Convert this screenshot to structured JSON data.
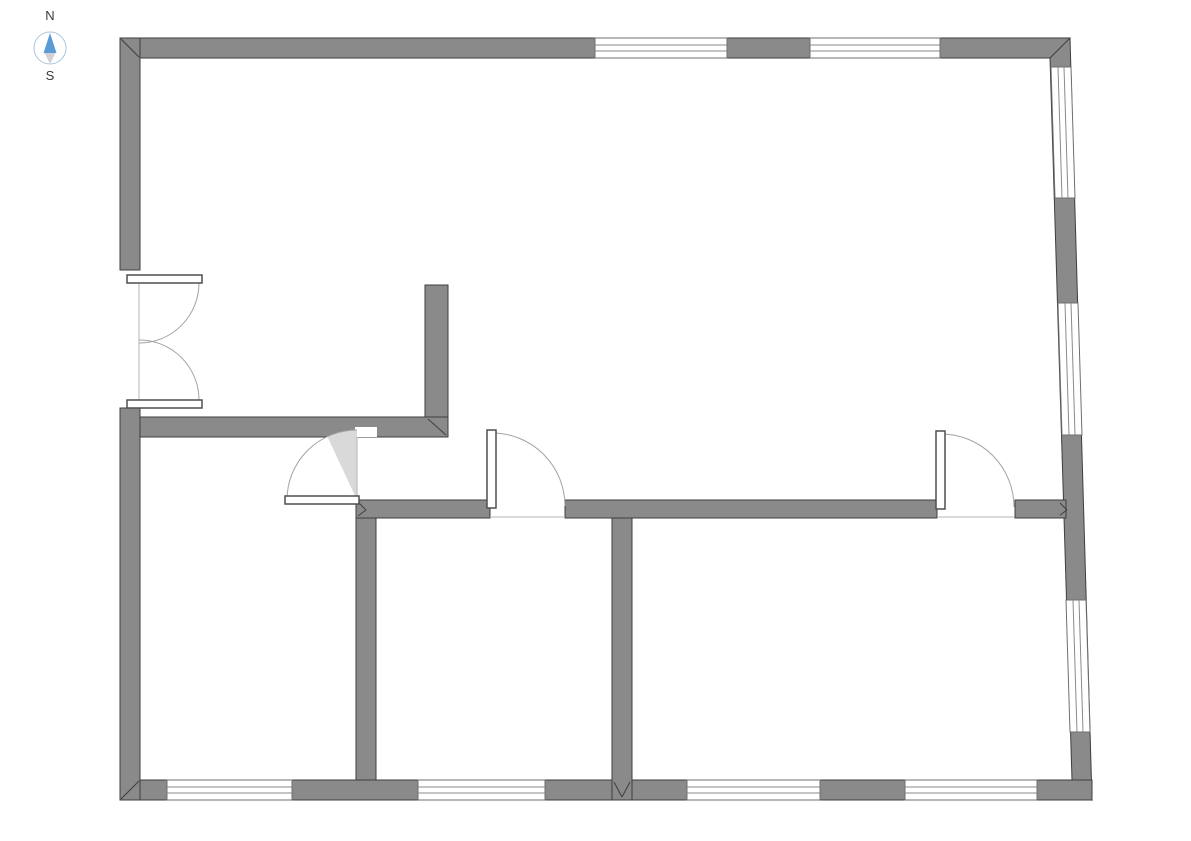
{
  "compass": {
    "north_label": "N",
    "south_label": "S",
    "label_color": "#3a3a3a",
    "ring_color": "#aac6de",
    "needle_north_color": "#5b9bd5",
    "needle_south_color": "#d2d2d2"
  },
  "colors": {
    "background": "#ffffff",
    "wall_fill": "#8a8a8a",
    "wall_stroke": "#3e3e3e",
    "window_fill": "#ffffff",
    "window_stroke": "#6f6f6f",
    "glazing_line": "#8a8a8a",
    "door_arc": "#a3a3a3",
    "door_leaf_fill": "#ffffff",
    "door_leaf_stroke": "#4f4f4f",
    "door_line": "#b5b5b5",
    "swing_wedge": "#d9d9d9"
  },
  "floorplan": {
    "walls": [
      {
        "name": "outer-wall-top",
        "points": [
          [
            120,
            38
          ],
          [
            1070,
            38
          ],
          [
            1070,
            58
          ],
          [
            120,
            58
          ]
        ]
      },
      {
        "name": "outer-wall-right",
        "points": [
          [
            1070,
            38
          ],
          [
            1092,
            800
          ],
          [
            1072,
            780
          ],
          [
            1050,
            58
          ]
        ]
      },
      {
        "name": "outer-wall-bottom",
        "points": [
          [
            120,
            780
          ],
          [
            1092,
            780
          ],
          [
            1092,
            800
          ],
          [
            120,
            800
          ]
        ]
      },
      {
        "name": "outer-wall-left-upper",
        "points": [
          [
            120,
            38
          ],
          [
            140,
            38
          ],
          [
            140,
            270
          ],
          [
            120,
            270
          ]
        ]
      },
      {
        "name": "outer-wall-left-lower",
        "points": [
          [
            120,
            408
          ],
          [
            140,
            408
          ],
          [
            140,
            800
          ],
          [
            120,
            800
          ]
        ]
      },
      {
        "name": "hall-wall-horizontal",
        "points": [
          [
            140,
            417
          ],
          [
            448,
            417
          ],
          [
            448,
            437
          ],
          [
            140,
            437
          ]
        ]
      },
      {
        "name": "hall-wall-vertical",
        "points": [
          [
            425,
            285
          ],
          [
            448,
            285
          ],
          [
            448,
            417
          ],
          [
            425,
            417
          ]
        ]
      },
      {
        "name": "south-wall-west",
        "points": [
          [
            356,
            500
          ],
          [
            490,
            500
          ],
          [
            490,
            518
          ],
          [
            356,
            518
          ]
        ]
      },
      {
        "name": "south-wall-center",
        "points": [
          [
            565,
            500
          ],
          [
            937,
            500
          ],
          [
            937,
            518
          ],
          [
            565,
            518
          ]
        ]
      },
      {
        "name": "south-wall-east",
        "points": [
          [
            1015,
            500
          ],
          [
            1066,
            500
          ],
          [
            1066,
            518
          ],
          [
            1015,
            518
          ]
        ]
      },
      {
        "name": "room-divider-west",
        "points": [
          [
            356,
            518
          ],
          [
            376,
            518
          ],
          [
            376,
            780
          ],
          [
            356,
            780
          ]
        ]
      },
      {
        "name": "room-divider-center",
        "points": [
          [
            612,
            518
          ],
          [
            632,
            518
          ],
          [
            632,
            800
          ],
          [
            612,
            800
          ]
        ]
      }
    ],
    "windows": [
      {
        "name": "top-window-1",
        "points": [
          [
            595,
            38
          ],
          [
            727,
            38
          ],
          [
            727,
            58
          ],
          [
            595,
            58
          ]
        ],
        "lines": [
          [
            595,
            45,
            727,
            45
          ],
          [
            595,
            51,
            727,
            51
          ]
        ]
      },
      {
        "name": "top-window-2",
        "points": [
          [
            810,
            38
          ],
          [
            940,
            38
          ],
          [
            940,
            58
          ],
          [
            810,
            58
          ]
        ],
        "lines": [
          [
            810,
            45,
            940,
            45
          ],
          [
            810,
            51,
            940,
            51
          ]
        ]
      },
      {
        "name": "right-window-1",
        "points": [
          [
            1051,
            67
          ],
          [
            1071,
            67
          ],
          [
            1075,
            198
          ],
          [
            1055,
            198
          ]
        ],
        "lines": [
          [
            1058,
            67,
            1062,
            198
          ],
          [
            1064,
            67,
            1068,
            198
          ]
        ]
      },
      {
        "name": "right-window-2",
        "points": [
          [
            1058,
            303
          ],
          [
            1078,
            303
          ],
          [
            1082,
            435
          ],
          [
            1062,
            435
          ]
        ],
        "lines": [
          [
            1065,
            303,
            1069,
            435
          ],
          [
            1071,
            303,
            1075,
            435
          ]
        ]
      },
      {
        "name": "right-window-3",
        "points": [
          [
            1066,
            600
          ],
          [
            1086,
            600
          ],
          [
            1090,
            732
          ],
          [
            1070,
            732
          ]
        ],
        "lines": [
          [
            1073,
            600,
            1077,
            732
          ],
          [
            1079,
            600,
            1083,
            732
          ]
        ]
      },
      {
        "name": "bottom-window-1",
        "points": [
          [
            167,
            780
          ],
          [
            292,
            780
          ],
          [
            292,
            800
          ],
          [
            167,
            800
          ]
        ],
        "lines": [
          [
            167,
            787,
            292,
            787
          ],
          [
            167,
            793,
            292,
            793
          ]
        ]
      },
      {
        "name": "bottom-window-2",
        "points": [
          [
            418,
            780
          ],
          [
            545,
            780
          ],
          [
            545,
            800
          ],
          [
            418,
            800
          ]
        ],
        "lines": [
          [
            418,
            787,
            545,
            787
          ],
          [
            418,
            793,
            545,
            793
          ]
        ]
      },
      {
        "name": "bottom-window-3",
        "points": [
          [
            687,
            780
          ],
          [
            820,
            780
          ],
          [
            820,
            800
          ],
          [
            687,
            800
          ]
        ],
        "lines": [
          [
            687,
            787,
            820,
            787
          ],
          [
            687,
            793,
            820,
            793
          ]
        ]
      },
      {
        "name": "bottom-window-4",
        "points": [
          [
            905,
            780
          ],
          [
            1037,
            780
          ],
          [
            1037,
            800
          ],
          [
            905,
            800
          ]
        ],
        "lines": [
          [
            905,
            787,
            1037,
            787
          ],
          [
            905,
            793,
            1037,
            793
          ]
        ]
      }
    ],
    "doors": [
      {
        "name": "entry-double-door",
        "rects": [],
        "sectors": [],
        "arcs": [
          {
            "cx": 139,
            "cy": 283,
            "r": 60,
            "a1": 0,
            "a2": 90,
            "sweep": 1
          },
          {
            "cx": 139,
            "cy": 400,
            "r": 60,
            "a1": 0,
            "a2": -90,
            "sweep": 0
          }
        ],
        "leafs": [
          {
            "x": 127,
            "y": 275,
            "w": 75,
            "h": 8
          },
          {
            "x": 127,
            "y": 400,
            "w": 75,
            "h": 8
          }
        ],
        "lines": [
          [
            139,
            283,
            139,
            400
          ]
        ]
      },
      {
        "name": "hallway-door",
        "rects": [
          {
            "x": 355,
            "y": 427,
            "w": 22,
            "h": 10
          }
        ],
        "sectors": [
          {
            "cx": 357,
            "cy": 500,
            "r": 70,
            "a1": 180,
            "a2": -90,
            "sweep": 1,
            "fill": "#ffffff"
          },
          {
            "cx": 357,
            "cy": 500,
            "r": 70,
            "a1": -90,
            "a2": -115,
            "sweep": 0,
            "fill": "#d9d9d9"
          }
        ],
        "arcs": [
          {
            "cx": 357,
            "cy": 500,
            "r": 70,
            "a1": 180,
            "a2": -90,
            "sweep": 1
          }
        ],
        "leafs": [
          {
            "x": 285,
            "y": 496,
            "w": 74,
            "h": 8
          }
        ],
        "lines": [
          [
            357,
            437,
            357,
            497
          ]
        ]
      },
      {
        "name": "middle-room-door",
        "rects": [],
        "sectors": [
          {
            "cx": 492,
            "cy": 506,
            "r": 73,
            "a1": -90,
            "a2": 0,
            "sweep": 1,
            "fill": "#ffffff"
          }
        ],
        "arcs": [
          {
            "cx": 492,
            "cy": 506,
            "r": 73,
            "a1": -90,
            "a2": 0,
            "sweep": 1
          }
        ],
        "leafs": [
          {
            "x": 487,
            "y": 430,
            "w": 9,
            "h": 78
          }
        ],
        "lines": [
          [
            490,
            517,
            565,
            517
          ]
        ]
      },
      {
        "name": "right-room-door",
        "rects": [],
        "sectors": [
          {
            "cx": 941,
            "cy": 507,
            "r": 73,
            "a1": -90,
            "a2": 0,
            "sweep": 1,
            "fill": "#ffffff"
          }
        ],
        "arcs": [
          {
            "cx": 941,
            "cy": 507,
            "r": 73,
            "a1": -90,
            "a2": 0,
            "sweep": 1
          }
        ],
        "leafs": [
          {
            "x": 936,
            "y": 431,
            "w": 9,
            "h": 78
          }
        ],
        "lines": [
          [
            937,
            517,
            1014,
            517
          ]
        ]
      }
    ],
    "joints": [
      [
        121,
        39,
        139,
        57
      ],
      [
        121,
        799,
        139,
        781
      ],
      [
        428,
        419,
        446,
        435
      ],
      [
        614,
        782,
        622,
        797
      ],
      [
        630,
        782,
        622,
        797
      ],
      [
        358,
        502,
        366,
        510
      ],
      [
        358,
        516,
        366,
        510
      ],
      [
        1060,
        503,
        1067,
        510
      ],
      [
        1060,
        515,
        1067,
        510
      ]
    ]
  }
}
